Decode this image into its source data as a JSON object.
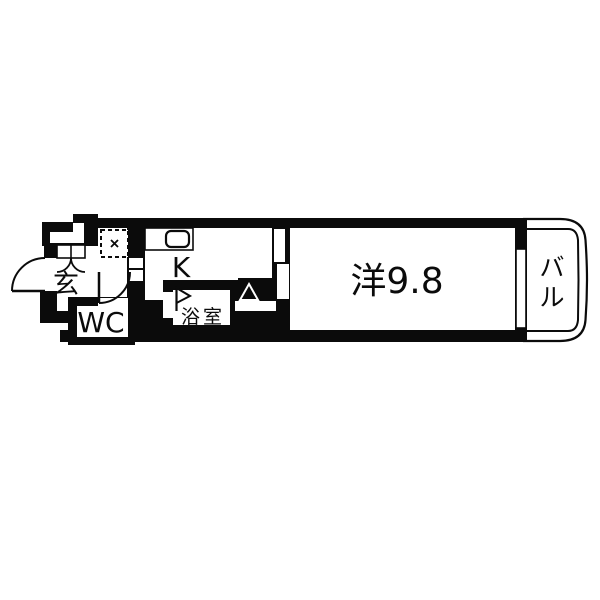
{
  "page": {
    "background": "#ffffff"
  },
  "floor_plan": {
    "kind": "apartment-floor-plan",
    "colors": {
      "wall": "#0b0b0b",
      "floor": "#ffffff"
    },
    "rooms": {
      "entrance": {
        "label": "玄"
      },
      "toilet": {
        "label": "WC"
      },
      "kitchen": {
        "label": "K"
      },
      "bathroom": {
        "label": "浴室"
      },
      "main_room": {
        "label": "洋9.8"
      },
      "balcony": {
        "label": "バル",
        "chars": [
          "バ",
          "ル"
        ]
      }
    },
    "icons": [
      "entrance-door-swing-icon",
      "shoe-cabinet-doors-icon",
      "wc-door-swing-icon",
      "laundry-space-icon",
      "kitchen-sink-icon",
      "sliding-door-icon",
      "bathroom-flag-icon",
      "triangle-marker-icon",
      "window-icon"
    ]
  }
}
